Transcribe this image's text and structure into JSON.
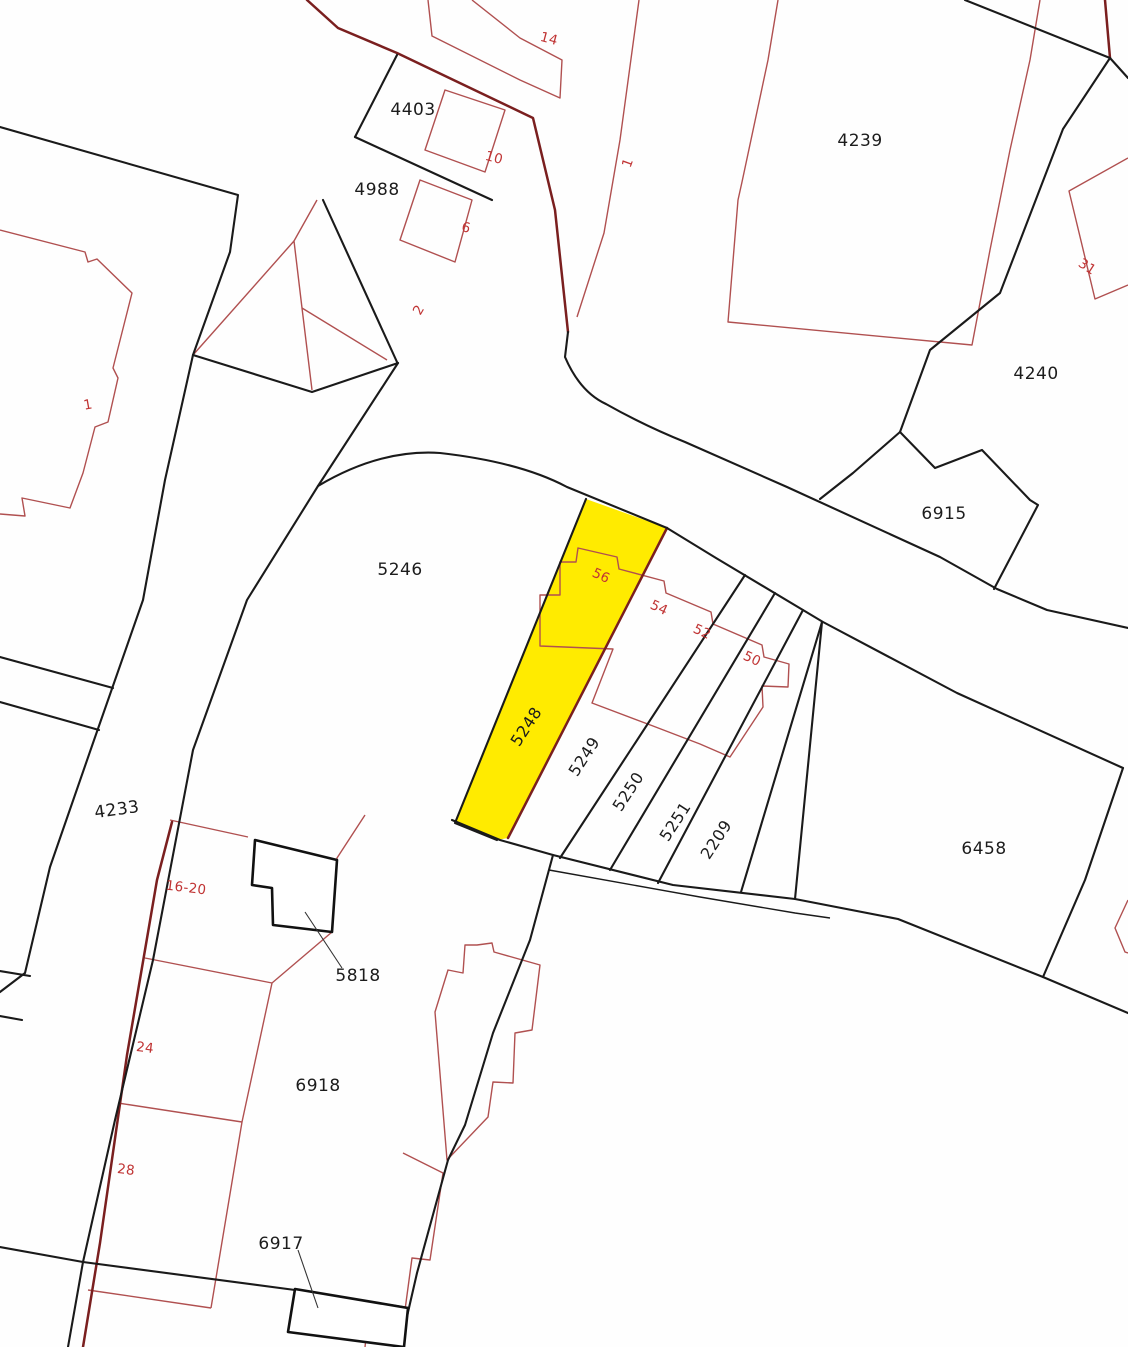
{
  "map": {
    "type": "cadastral-parcel-map",
    "selected_parcel": "5248",
    "colors": {
      "highlight": "#ffeb00",
      "boundary": "#1a1a1a",
      "building_outline": "#b05050",
      "building_dark": "#7a1f1f",
      "house_number_text": "#c03434",
      "parcel_text": "#1c1c1c",
      "background": "#ffffff"
    },
    "labels": [
      {
        "text": "4403",
        "x": 413,
        "y": 110,
        "rot": 0,
        "kind": "parcel"
      },
      {
        "text": "4988",
        "x": 377,
        "y": 190,
        "rot": 0,
        "kind": "parcel"
      },
      {
        "text": "4239",
        "x": 860,
        "y": 141,
        "rot": 0,
        "kind": "parcel"
      },
      {
        "text": "4240",
        "x": 1036,
        "y": 374,
        "rot": 0,
        "kind": "parcel"
      },
      {
        "text": "6915",
        "x": 944,
        "y": 514,
        "rot": 0,
        "kind": "parcel"
      },
      {
        "text": "5246",
        "x": 400,
        "y": 570,
        "rot": 0,
        "kind": "parcel"
      },
      {
        "text": "4233",
        "x": 117,
        "y": 810,
        "rot": -8,
        "kind": "parcel"
      },
      {
        "text": "6458",
        "x": 984,
        "y": 849,
        "rot": 0,
        "kind": "parcel"
      },
      {
        "text": "5818",
        "x": 358,
        "y": 976,
        "rot": 0,
        "kind": "parcel"
      },
      {
        "text": "6918",
        "x": 318,
        "y": 1086,
        "rot": 0,
        "kind": "parcel"
      },
      {
        "text": "6917",
        "x": 281,
        "y": 1244,
        "rot": 0,
        "kind": "parcel"
      },
      {
        "text": "5248",
        "x": 527,
        "y": 727,
        "rot": -57,
        "kind": "strip"
      },
      {
        "text": "5249",
        "x": 585,
        "y": 757,
        "rot": -57,
        "kind": "strip"
      },
      {
        "text": "5250",
        "x": 629,
        "y": 792,
        "rot": -57,
        "kind": "strip"
      },
      {
        "text": "5251",
        "x": 676,
        "y": 822,
        "rot": -57,
        "kind": "strip"
      },
      {
        "text": "2209",
        "x": 717,
        "y": 840,
        "rot": -57,
        "kind": "strip"
      },
      {
        "text": "14",
        "x": 549,
        "y": 39,
        "rot": 15,
        "kind": "house"
      },
      {
        "text": "10",
        "x": 494,
        "y": 158,
        "rot": 15,
        "kind": "house"
      },
      {
        "text": "6",
        "x": 466,
        "y": 228,
        "rot": 12,
        "kind": "house"
      },
      {
        "text": "2",
        "x": 419,
        "y": 310,
        "rot": -60,
        "kind": "house"
      },
      {
        "text": "1",
        "x": 628,
        "y": 163,
        "rot": -70,
        "kind": "house"
      },
      {
        "text": "31",
        "x": 1087,
        "y": 267,
        "rot": 33,
        "kind": "house"
      },
      {
        "text": "1",
        "x": 88,
        "y": 405,
        "rot": -10,
        "kind": "house"
      },
      {
        "text": "56",
        "x": 601,
        "y": 576,
        "rot": 25,
        "kind": "house"
      },
      {
        "text": "54",
        "x": 659,
        "y": 608,
        "rot": 25,
        "kind": "house"
      },
      {
        "text": "52",
        "x": 702,
        "y": 632,
        "rot": 25,
        "kind": "house"
      },
      {
        "text": "50",
        "x": 752,
        "y": 659,
        "rot": 25,
        "kind": "house"
      },
      {
        "text": "16-20",
        "x": 186,
        "y": 888,
        "rot": 7,
        "kind": "house"
      },
      {
        "text": "24",
        "x": 145,
        "y": 1048,
        "rot": 7,
        "kind": "house"
      },
      {
        "text": "28",
        "x": 126,
        "y": 1170,
        "rot": 7,
        "kind": "house"
      }
    ]
  }
}
